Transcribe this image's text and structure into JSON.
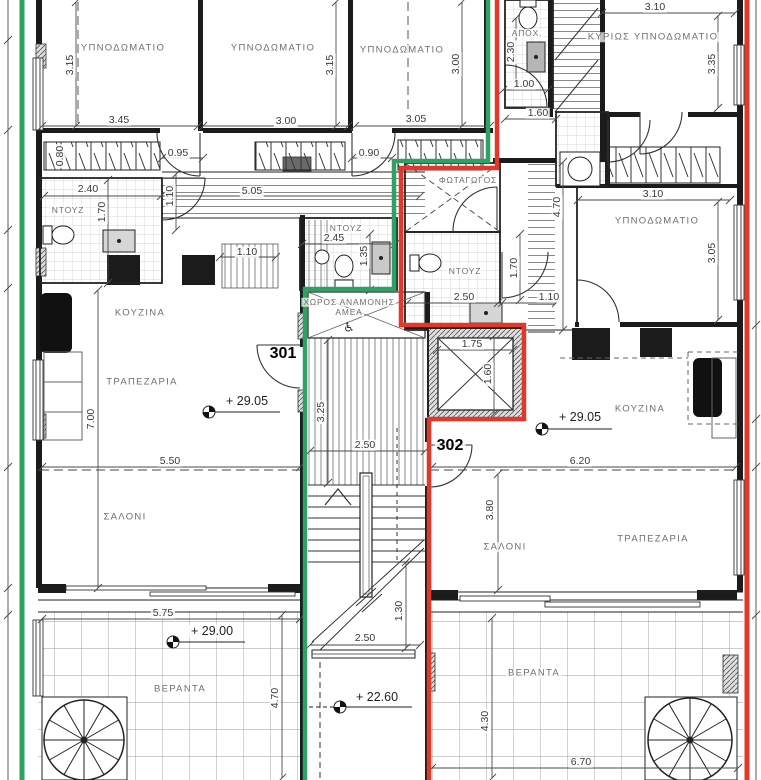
{
  "units": [
    {
      "number": "301",
      "boundary_color": "#2fa163"
    },
    {
      "number": "302",
      "boundary_color": "#e2382c"
    }
  ],
  "rooms": [
    {
      "label": "ΥΠΝΟΔΩΜΑΤΙΟ"
    },
    {
      "label": "ΥΠΝΟΔΩΜΑΤΙΟ"
    },
    {
      "label": "ΥΠΝΟΔΩΜΑΤΙΟ"
    },
    {
      "label": "ΚΥΡΙΩΣ ΥΠΝΟΔΩΜΑΤΙΟ"
    },
    {
      "label": "ΥΠΝΟΔΩΜΑΤΙΟ"
    },
    {
      "label": "ΦΩΤΑΓΩΓΟΣ"
    },
    {
      "label": "ΑΠΟΧ."
    },
    {
      "label": "ΝΤΟΥΖ"
    },
    {
      "label": "ΝΤΟΥΖ"
    },
    {
      "label": "ΝΤΟΥΖ"
    },
    {
      "label": "ΚΟΥΖΙΝΑ"
    },
    {
      "label": "ΚΟΥΖΙΝΑ"
    },
    {
      "label": "ΤΡΑΠΕΖΑΡΙΑ"
    },
    {
      "label": "ΤΡΑΠΕΖΑΡΙΑ"
    },
    {
      "label": "ΣΑΛΟΝΙ"
    },
    {
      "label": "ΣΑΛΟΝΙ"
    },
    {
      "label": "ΒΕΡΑΝΤΑ"
    },
    {
      "label": "ΒΕΡΑΝΤΑ"
    },
    {
      "label": "ΧΩΡΟΣ ΑΝΑΜΟΝΗΣ"
    },
    {
      "label": "ΑΜΕΑ"
    }
  ],
  "levels": [
    {
      "label": "+ 29.05"
    },
    {
      "label": "+ 29.05"
    },
    {
      "label": "+ 29.00"
    },
    {
      "label": "+ 22.60"
    }
  ],
  "dims_h": [
    {
      "label": "3.45"
    },
    {
      "label": "3.00"
    },
    {
      "label": "3.05"
    },
    {
      "label": "3.10"
    },
    {
      "label": "0.95"
    },
    {
      "label": "0.90"
    },
    {
      "label": "2.40"
    },
    {
      "label": "5.05"
    },
    {
      "label": "1.00"
    },
    {
      "label": "1.60"
    },
    {
      "label": "3.10"
    },
    {
      "label": "2.45"
    },
    {
      "label": "2.50"
    },
    {
      "label": "1.10"
    },
    {
      "label": "1.10"
    },
    {
      "label": "1.75"
    },
    {
      "label": "2.50"
    },
    {
      "label": "5.50"
    },
    {
      "label": "6.20"
    },
    {
      "label": "5.75"
    },
    {
      "label": "2.50"
    },
    {
      "label": "6.70"
    }
  ],
  "dims_v": [
    {
      "label": "3.15"
    },
    {
      "label": "3.15"
    },
    {
      "label": "3.00"
    },
    {
      "label": "3.35"
    },
    {
      "label": "2.30"
    },
    {
      "label": "1.70"
    },
    {
      "label": "1.10"
    },
    {
      "label": "4.70"
    },
    {
      "label": "3.05"
    },
    {
      "label": "1.70"
    },
    {
      "label": "1.35"
    },
    {
      "label": "1.60"
    },
    {
      "label": "3.25"
    },
    {
      "label": "7.00"
    },
    {
      "label": "3.80"
    },
    {
      "label": "1.30"
    },
    {
      "label": "4.70"
    },
    {
      "label": "4.30"
    },
    {
      "label": "0.80"
    }
  ],
  "icons": {
    "wheelchair": "♿"
  }
}
